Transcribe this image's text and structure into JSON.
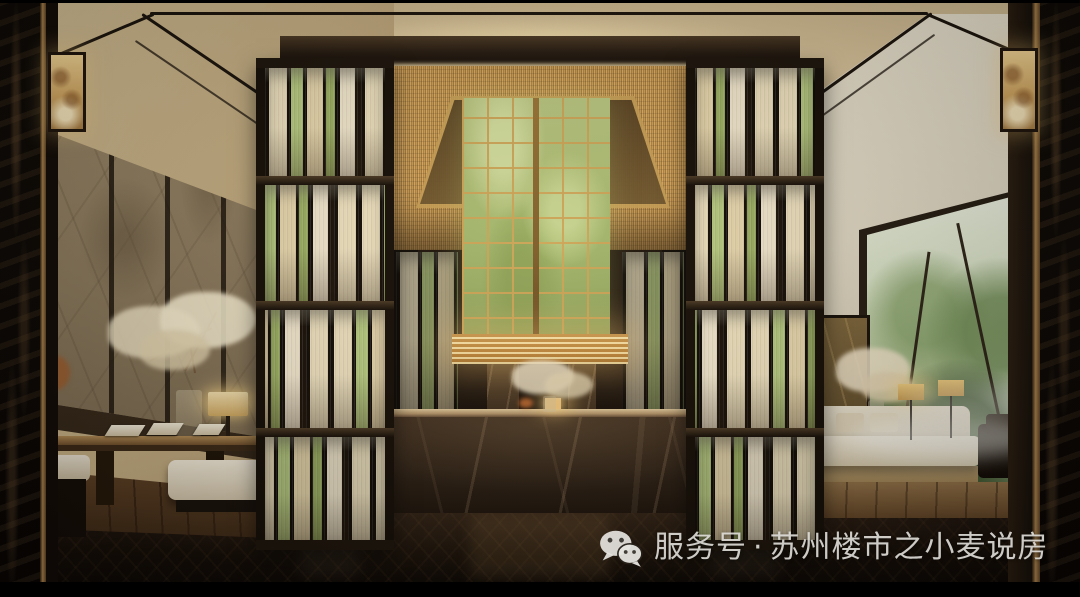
{
  "watermark": {
    "icon": "wechat-icon",
    "account_type_label": "服务号",
    "separator": "·",
    "account_name": "苏州楼市之小麦说房",
    "full_text": "服务号 · 苏州楼市之小麦说房",
    "text_color": "#e2e0db"
  },
  "palette": {
    "ceiling_beige": "#d5c09a",
    "trim_dark": "#171009",
    "wood_beam": "#3a2915",
    "gold_mesh": "#c89a55",
    "onyx_green": "#a9bd72",
    "gold_frame": "#c9a050",
    "desk_marble": "#302318",
    "left_wallpaper": "#8d7b5f",
    "right_wall_cream": "#e6dfcd",
    "slat_cream": "#f0e3c0",
    "slat_green": "#b7cb80",
    "floor_dark": "#170f09"
  }
}
